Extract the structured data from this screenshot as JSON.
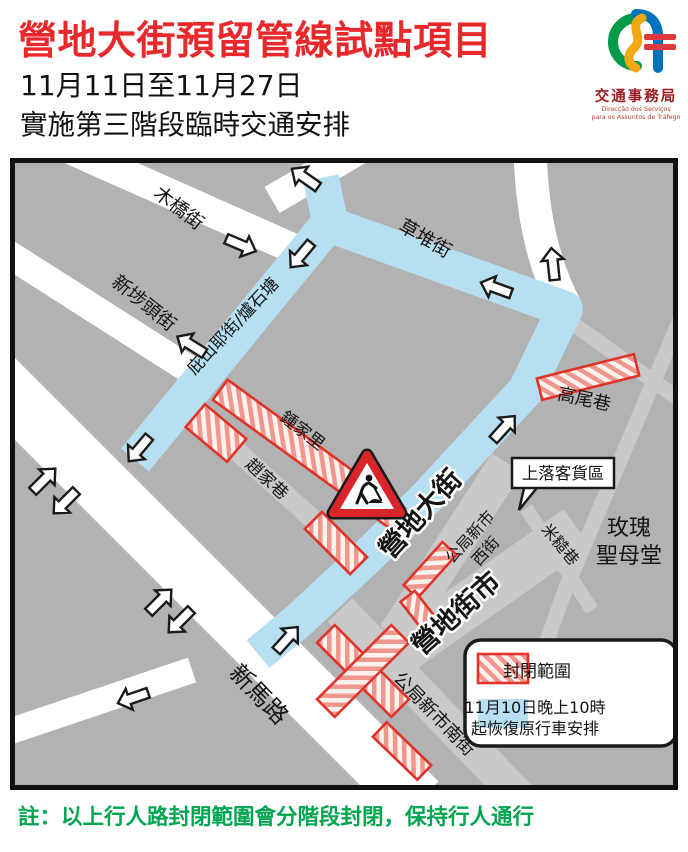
{
  "header": {
    "title": "營地大街預留管線試點項目",
    "date_range": "11月11日至11月27日",
    "subtitle": "實施第三階段臨時交通安排",
    "logo": {
      "org": "交通事務局",
      "pt_line1": "Direcção dos Serviços",
      "pt_line2": "para os Assuntos de Tráfego"
    }
  },
  "map": {
    "streets": {
      "muqiao": "木橋街",
      "xinbutou": "新埗頭街",
      "bishanye": "庇山耶街/爐石塘",
      "caodui": "草堆街",
      "zhongjiali": "鍾家里",
      "zhaojiaxiang": "趙家巷",
      "yingdi_dajie": "營地大街",
      "gaoweixiang": "高尾巷",
      "migaoxiang": "米糙巷",
      "gongju_xi_line1": "公局新市",
      "gongju_xi_line2": "西街",
      "gongju_nan": "公局新市南街",
      "xinmalu": "新馬路",
      "yingdi_jieshi": "營地街市",
      "church_line1": "玫瑰",
      "church_line2": "聖母堂"
    },
    "callout": {
      "label": "上落客貨區"
    },
    "legend": {
      "closed_label": "封閉範圍",
      "reopen_line1": "11月10日晚上10時",
      "reopen_line2": "起恢復原行車安排"
    }
  },
  "note": {
    "text": "註：以上行人路封閉範圍會分階段封閉，保持行人通行"
  },
  "colors": {
    "title_red": "#e8282b",
    "closure_red": "#e0332a",
    "reopened_blue": "#b6dff2",
    "note_green": "#00a550",
    "map_bg_gray": "#b2b2b2"
  }
}
